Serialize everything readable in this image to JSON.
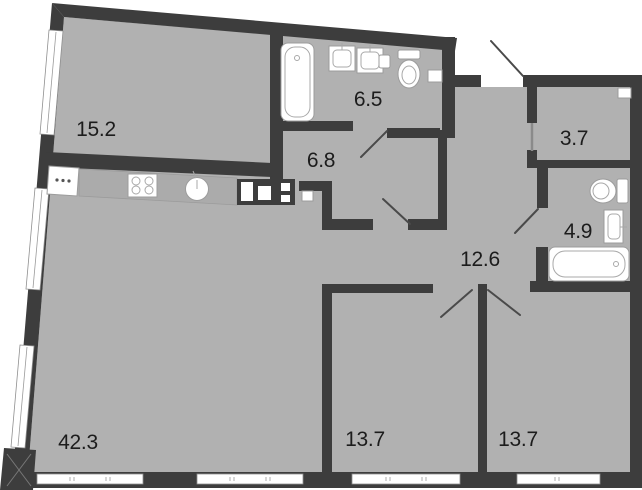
{
  "plan": {
    "rooms": [
      {
        "id": "kitchen-living-room",
        "label": "42.3"
      },
      {
        "id": "room-upper-left",
        "label": "15.2"
      },
      {
        "id": "bathroom-main",
        "label": "6.5"
      },
      {
        "id": "hallway-small",
        "label": "6.8"
      },
      {
        "id": "wardrobe",
        "label": "3.7"
      },
      {
        "id": "bathroom-second",
        "label": "4.9"
      },
      {
        "id": "corridor",
        "label": "12.6"
      },
      {
        "id": "bedroom-left",
        "label": "13.7"
      },
      {
        "id": "bedroom-right",
        "label": "13.7"
      }
    ]
  },
  "colors": {
    "wall": "#3d3d3d",
    "floor": "#b1b1b1",
    "counter": "#ababab",
    "background": "#ffffff",
    "fixture_outline": "#9c9c9c",
    "door_swing": "#4a4a4a",
    "label_text": "#1c1c1c"
  }
}
